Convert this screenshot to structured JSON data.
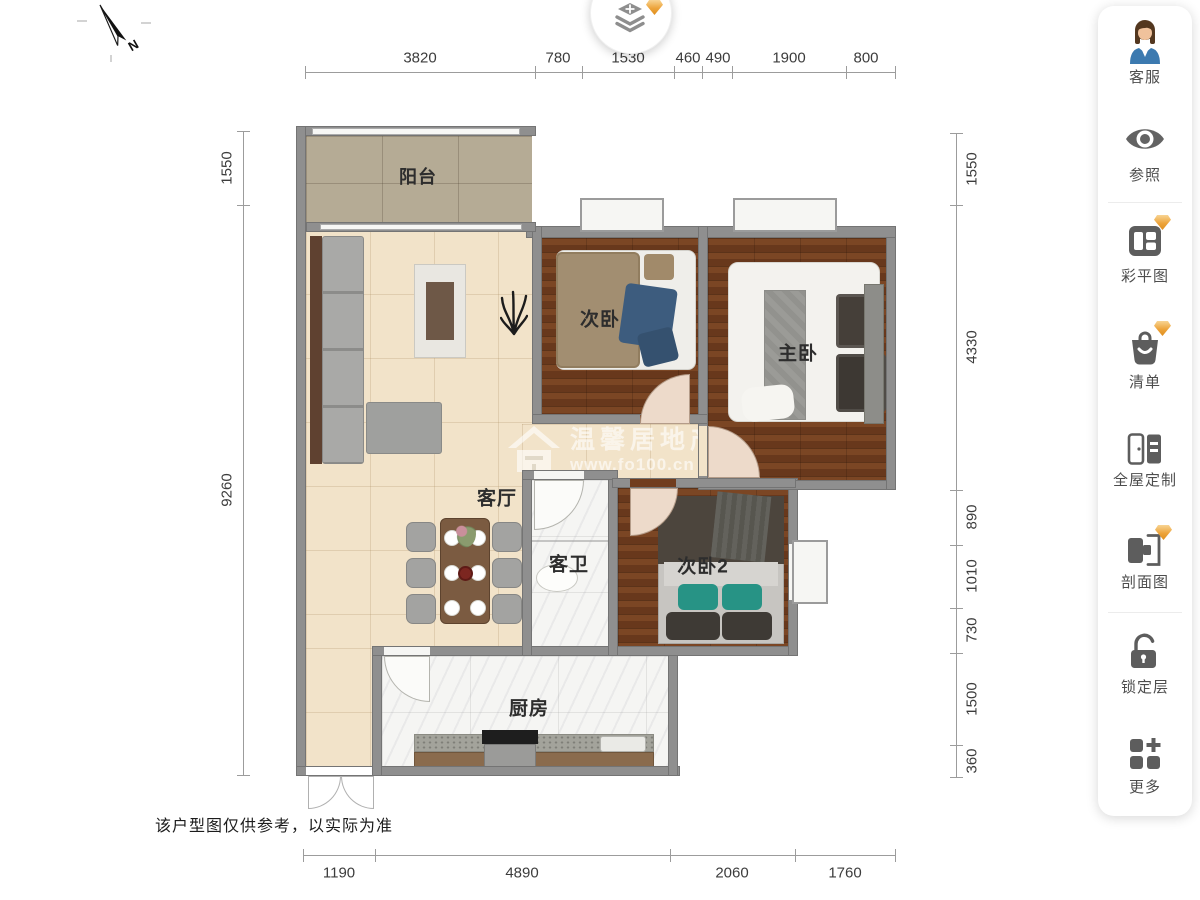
{
  "north": {
    "label": "N"
  },
  "dimensions": {
    "top": [
      "3820",
      "780",
      "1530",
      "460",
      "490",
      "1900",
      "800"
    ],
    "left": [
      "1550",
      "9260"
    ],
    "right": [
      "1550",
      "4330",
      "890",
      "1010",
      "730",
      "1500",
      "360"
    ],
    "bottom": [
      "1190",
      "4890",
      "2060",
      "1760"
    ]
  },
  "rooms": {
    "balcony": "阳台",
    "living": "客厅",
    "bedroom": "次卧",
    "master": "主卧",
    "bathroom": "客卫",
    "bedroom2": "次卧2",
    "kitchen": "厨房"
  },
  "watermark": {
    "brand": "温馨居地产",
    "url": "www.fo100.cn"
  },
  "disclaimer": "该户型图仅供参考，以实际为准",
  "sidebar": {
    "items": [
      {
        "label": "客服",
        "icon": "agent-avatar-icon",
        "premium": false
      },
      {
        "label": "参照",
        "icon": "eye-icon",
        "premium": false
      },
      {
        "label": "彩平图",
        "icon": "color-plan-icon",
        "premium": true
      },
      {
        "label": "清单",
        "icon": "list-bag-icon",
        "premium": true
      },
      {
        "label": "全屋定制",
        "icon": "wardrobe-icon",
        "premium": false
      },
      {
        "label": "剖面图",
        "icon": "section-view-icon",
        "premium": true
      },
      {
        "label": "锁定层",
        "icon": "lock-layer-icon",
        "premium": false
      },
      {
        "label": "更多",
        "icon": "more-grid-icon",
        "premium": false
      }
    ]
  },
  "colors": {
    "wall": "#8f8f8f",
    "wood_floor": "#713d1e",
    "cream_floor": "#f2e3c9",
    "balcony_floor": "#b5ab95",
    "marble_floor": "#f5f5f3",
    "premium_gem": "#eda43b",
    "icon_gray": "#5d5d5d"
  }
}
